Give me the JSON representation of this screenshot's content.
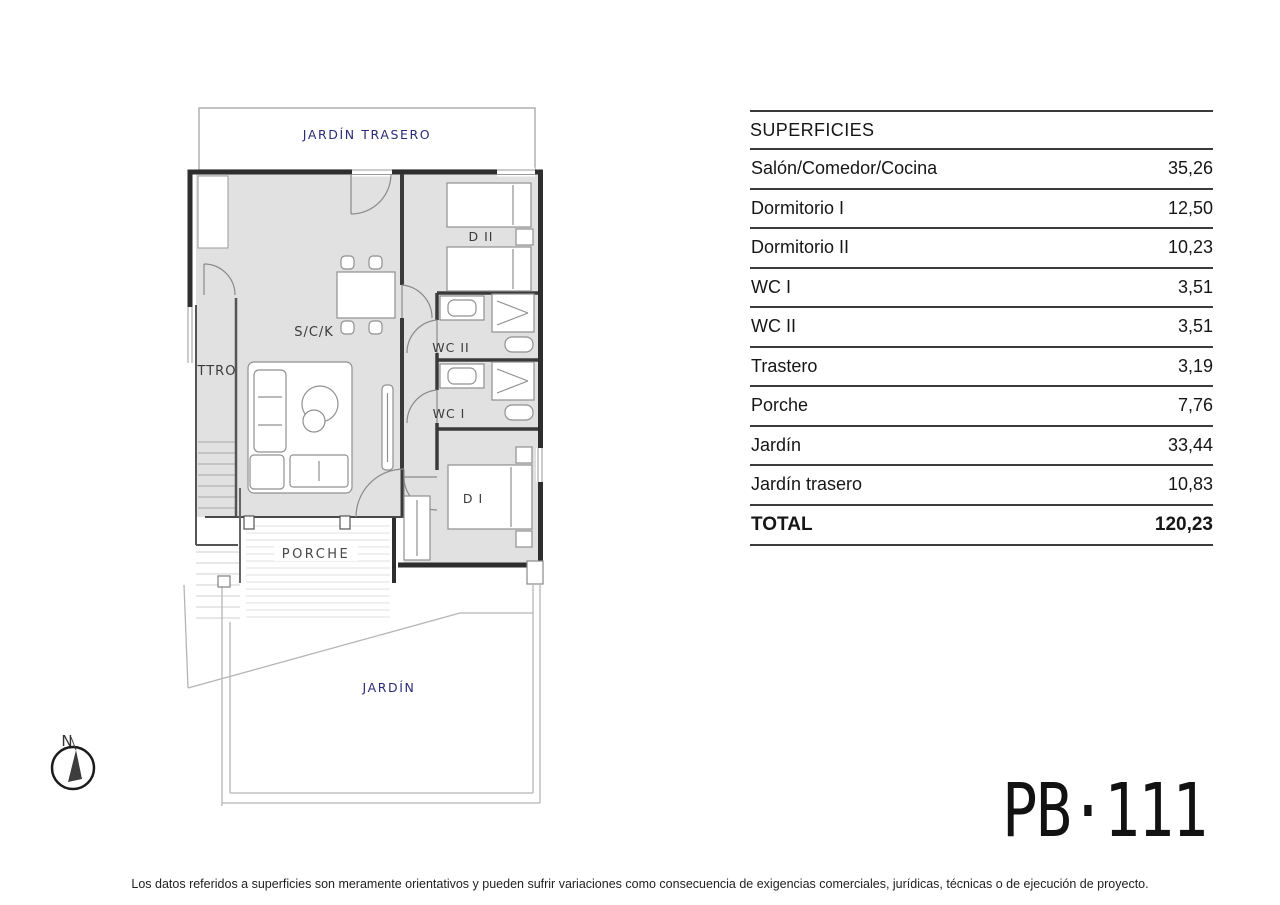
{
  "plan_code": "PB·111",
  "disclaimer": "Los datos referidos a superficies son meramente orientativos y pueden sufrir variaciones como consecuencia de exigencias comerciales, jurídicas, técnicas o de ejecución de proyecto.",
  "compass": {
    "north_label": "N"
  },
  "floor_plan": {
    "rooms": {
      "back_garden": "JARDÍN TRASERO",
      "bedroom2": "D II",
      "living": "S/C/K",
      "storage": "TTRO",
      "wc2": "WC II",
      "wc1": "WC I",
      "bedroom1": "D I",
      "porch": "PORCHE",
      "garden": "JARDÍN"
    },
    "colors": {
      "room_fill": "#e1e1e1",
      "wall": "#2e2e2e",
      "garden_outline": "#b5b5b5",
      "garden_label_color": "#2b2b78"
    }
  },
  "surfaces": {
    "title": "SUPERFICIES",
    "rows": [
      {
        "label": "Salón/Comedor/Cocina",
        "value": "35,26"
      },
      {
        "label": "Dormitorio I",
        "value": "12,50"
      },
      {
        "label": "Dormitorio II",
        "value": "10,23"
      },
      {
        "label": "WC I",
        "value": "3,51"
      },
      {
        "label": "WC II",
        "value": "3,51"
      },
      {
        "label": "Trastero",
        "value": "3,19"
      },
      {
        "label": "Porche",
        "value": "7,76"
      },
      {
        "label": "Jardín",
        "value": "33,44"
      },
      {
        "label": "Jardín trasero",
        "value": "10,83"
      }
    ],
    "total": {
      "label": "TOTAL",
      "value": "120,23"
    }
  }
}
